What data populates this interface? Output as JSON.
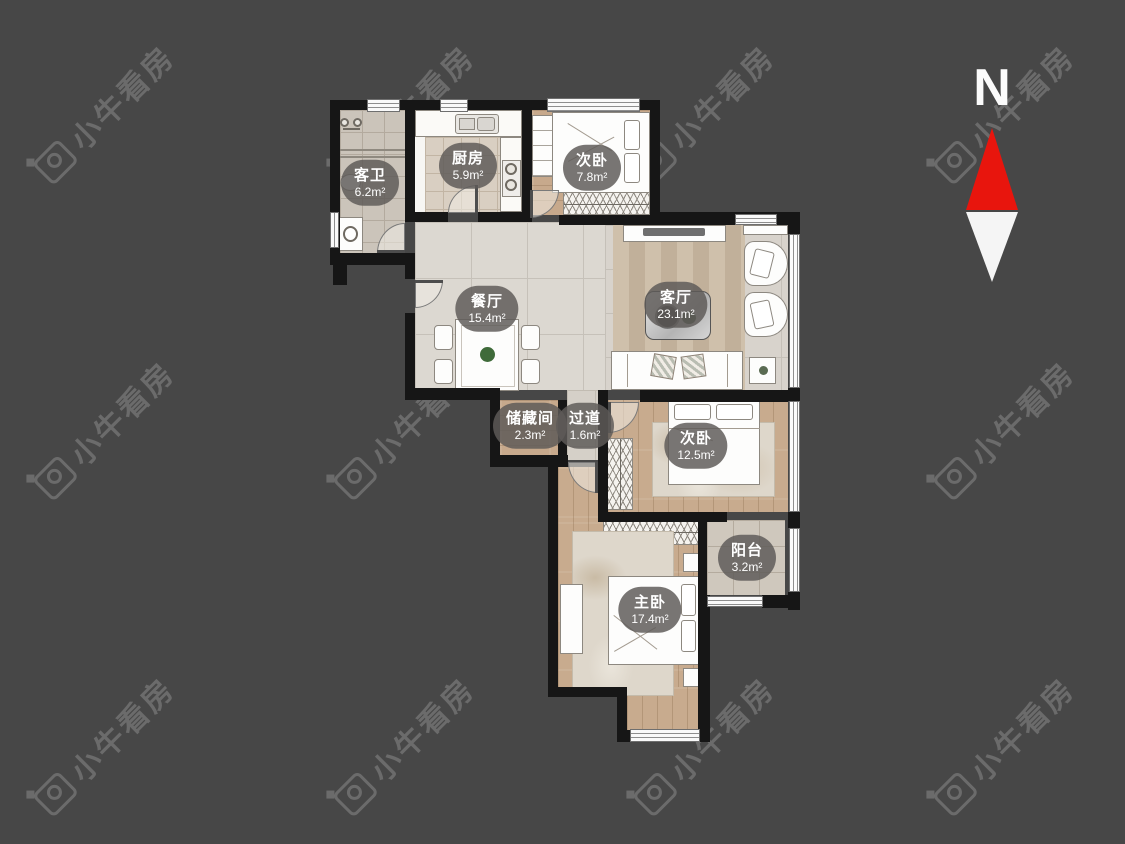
{
  "app": {
    "watermark_text": "小牛看房"
  },
  "compass": {
    "label": "N"
  },
  "rooms": [
    {
      "id": "guest-bathroom",
      "name": "客卫",
      "area": "6.2m²"
    },
    {
      "id": "kitchen",
      "name": "厨房",
      "area": "5.9m²"
    },
    {
      "id": "bedroom-north",
      "name": "次卧",
      "area": "7.8m²"
    },
    {
      "id": "dining-room",
      "name": "餐厅",
      "area": "15.4m²"
    },
    {
      "id": "living-room",
      "name": "客厅",
      "area": "23.1m²"
    },
    {
      "id": "storage-room",
      "name": "储藏间",
      "area": "2.3m²"
    },
    {
      "id": "hallway",
      "name": "过道",
      "area": "1.6m²"
    },
    {
      "id": "bedroom-east",
      "name": "次卧",
      "area": "12.5m²"
    },
    {
      "id": "balcony",
      "name": "阳台",
      "area": "3.2m²"
    },
    {
      "id": "master-bedroom",
      "name": "主卧",
      "area": "17.4m²"
    }
  ],
  "colors": {
    "background": "#474747",
    "wall": "#161616",
    "compass_north_red": "#e8150d",
    "label_background": "rgba(94,91,88,0.84)"
  }
}
